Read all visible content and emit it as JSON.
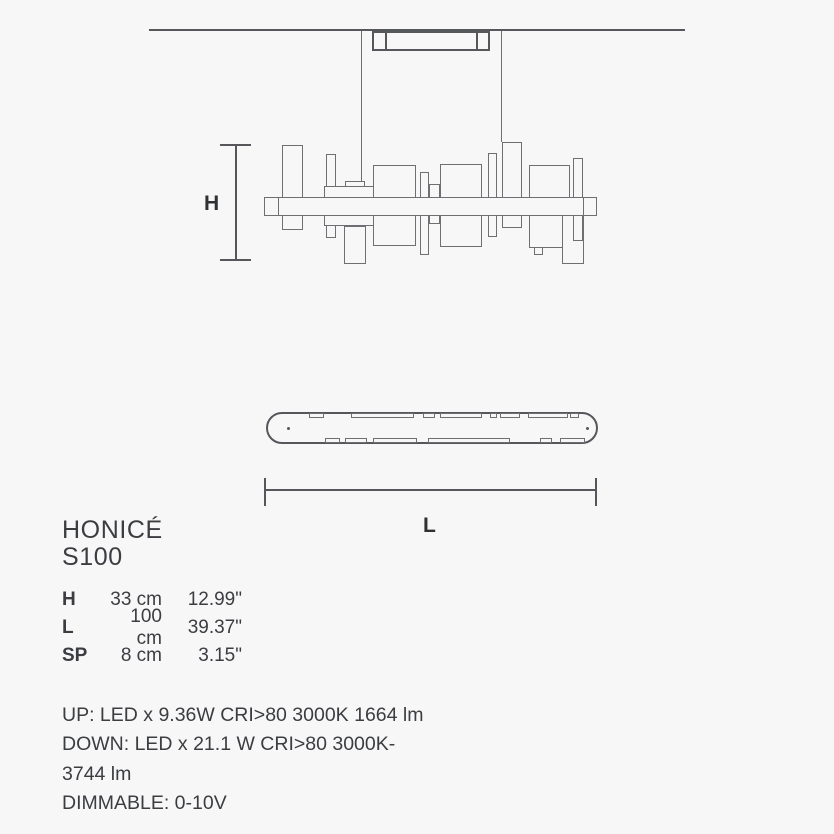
{
  "colors": {
    "background": "#f7f7f8",
    "line": "#6d6f72",
    "line_strong": "#55575a",
    "text": "#3b3d40"
  },
  "product": {
    "name": "HONICÉ",
    "model": "S100"
  },
  "diagram_labels": {
    "height": "H",
    "length": "L"
  },
  "dimension_table": {
    "rows": [
      {
        "label": "H",
        "metric": "33 cm",
        "imperial": "12.99\""
      },
      {
        "label": "L",
        "metric": "100 cm",
        "imperial": "39.37\""
      },
      {
        "label": "SP",
        "metric": "8 cm",
        "imperial": "3.15\""
      }
    ]
  },
  "specs": {
    "lines": [
      "UP: LED x 9.36W CRI>80 3000K 1664 lm",
      "DOWN: LED x 21.1 W CRI>80 3000K-",
      "3744 lm",
      "DIMMABLE: 0-10V"
    ]
  }
}
